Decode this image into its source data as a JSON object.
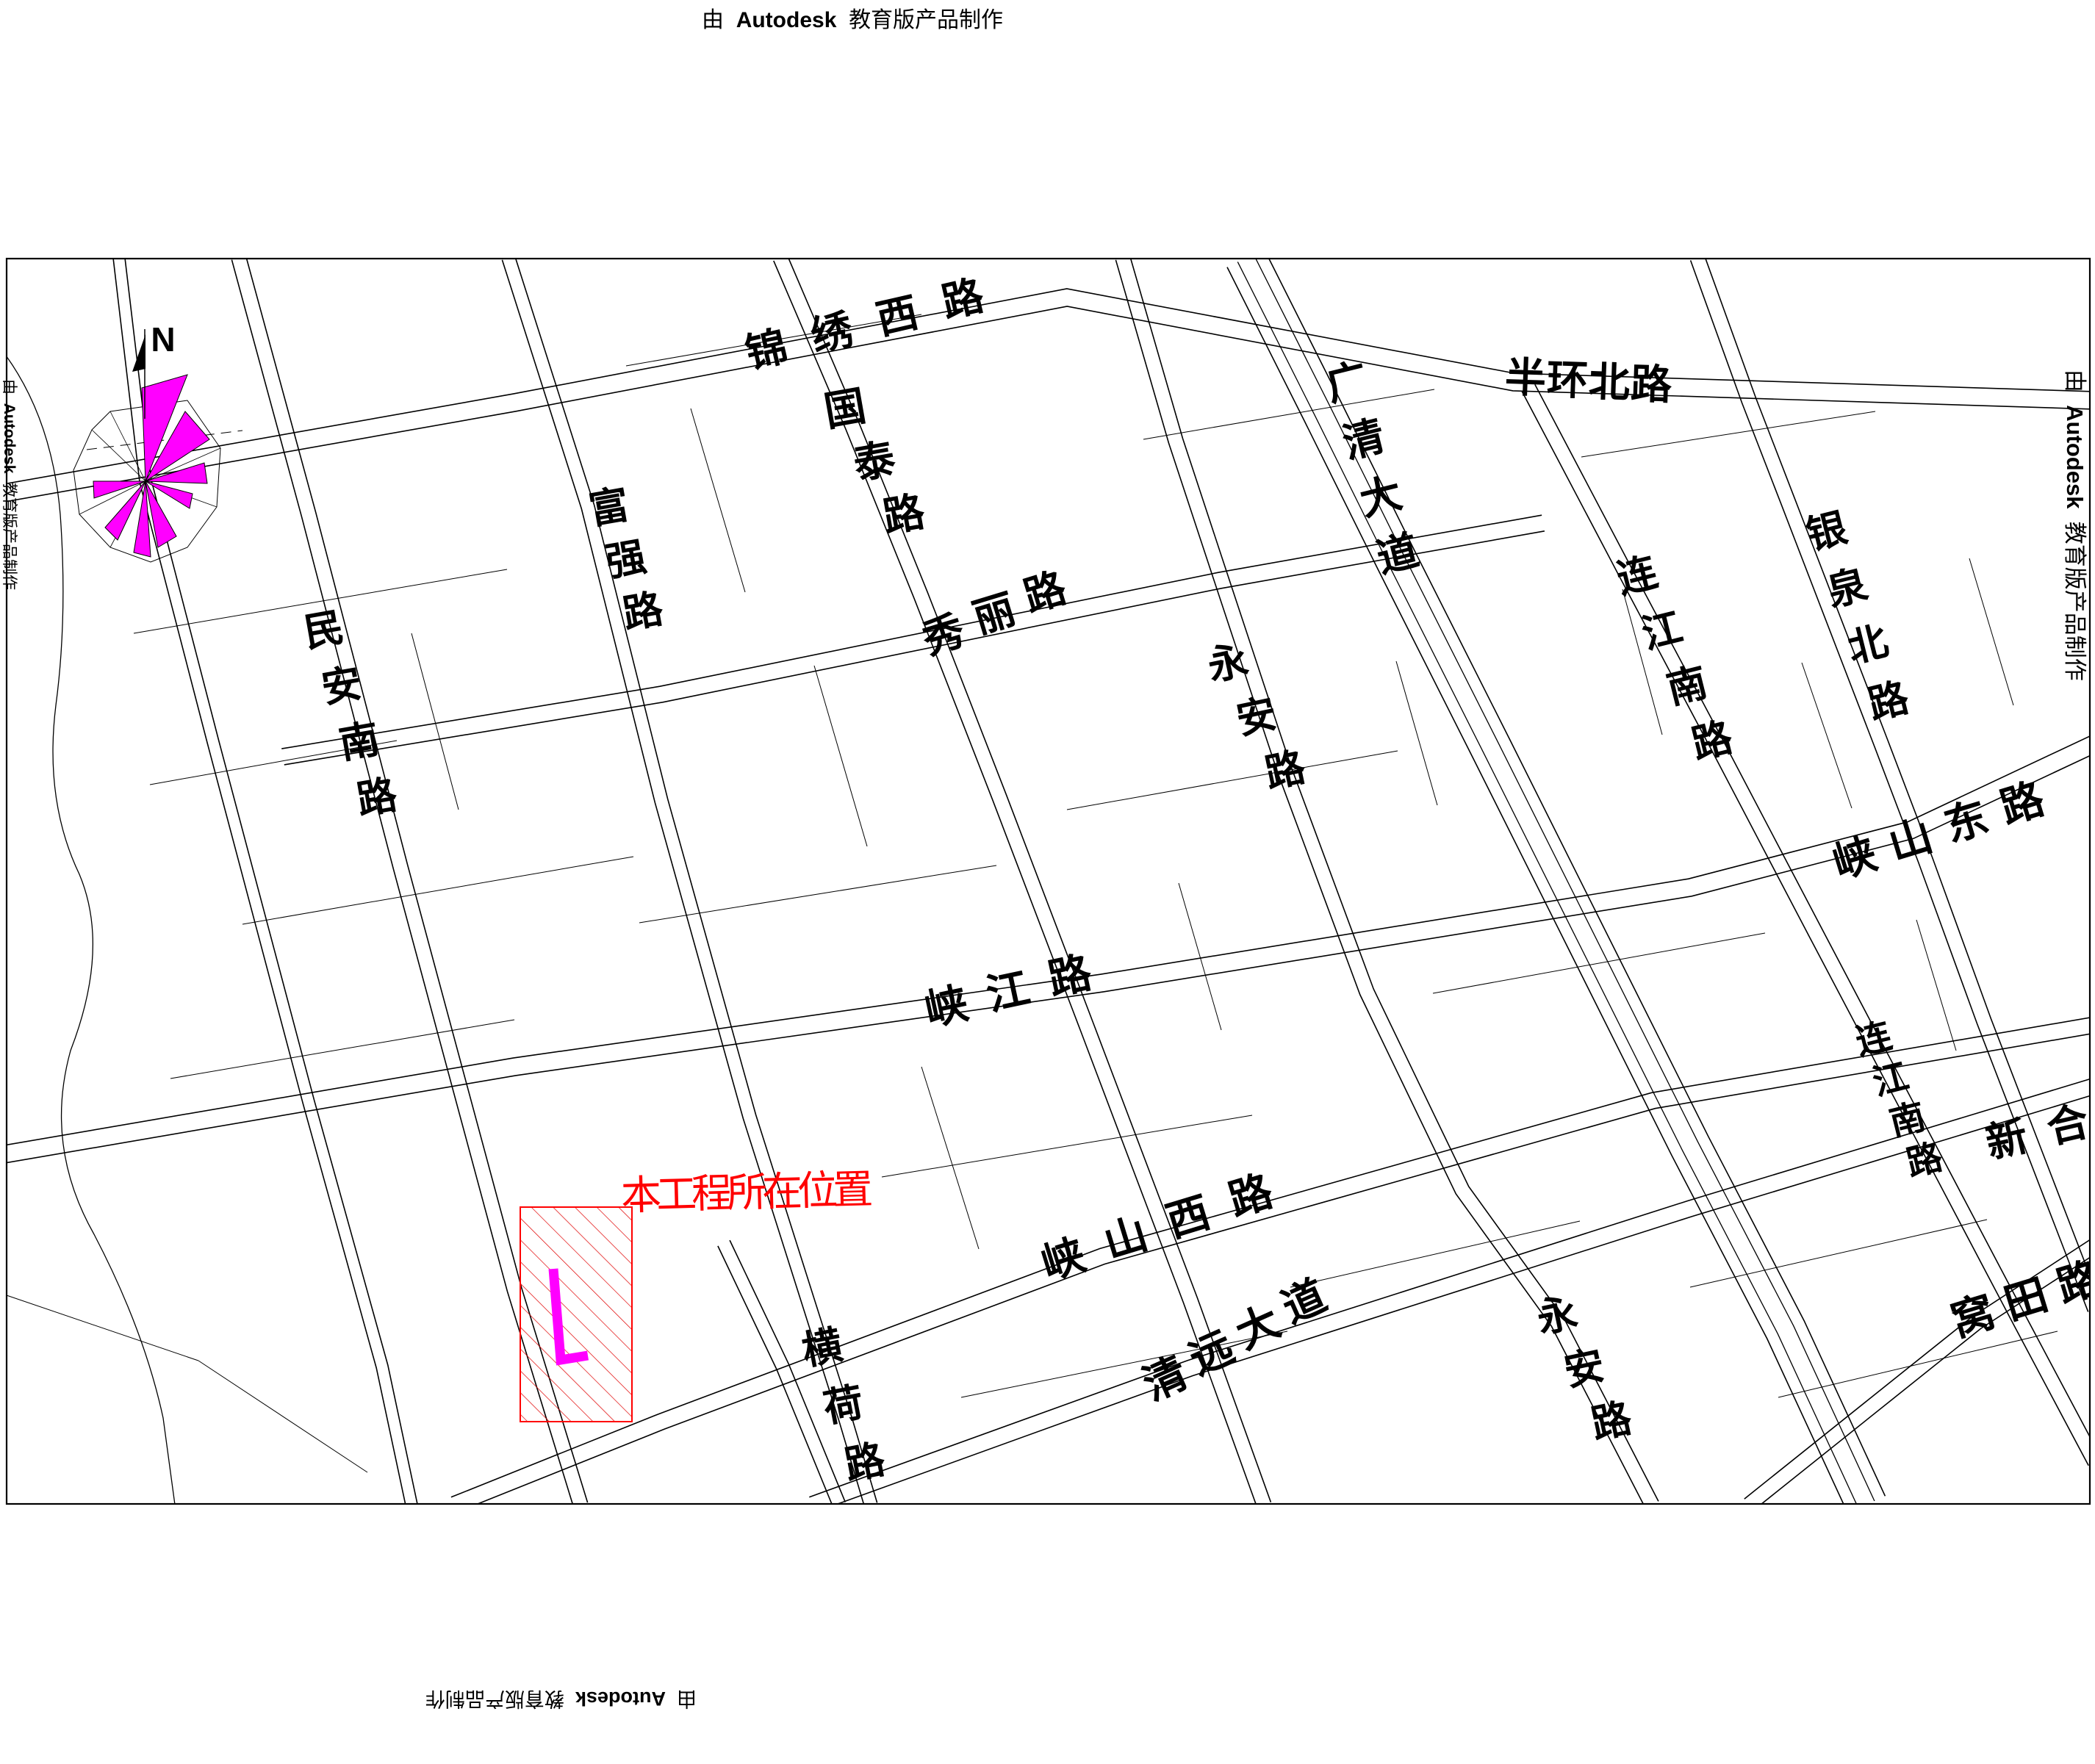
{
  "watermark": {
    "prefix": "由",
    "brand": "Autodesk",
    "suffix": "教育版产品制作"
  },
  "compass": {
    "north_label": "N"
  },
  "legend": {
    "project_location_label": "本工程所在位置"
  },
  "colors": {
    "line_black": "#000000",
    "project_red": "#FF0000",
    "hatch_red": "#E00000",
    "site_magenta": "#FF00FF",
    "wind_rose_magenta": "#FF00FF"
  },
  "roads": [
    {
      "id": "jinxiu",
      "name": "锦绣西路"
    },
    {
      "id": "banhuan",
      "name": "半环北路"
    },
    {
      "id": "guotai",
      "name": "国泰路"
    },
    {
      "id": "guangqing",
      "name": "广清大道"
    },
    {
      "id": "lianjiang-n",
      "name": "连江南路"
    },
    {
      "id": "yinquan",
      "name": "银泉北路"
    },
    {
      "id": "minan",
      "name": "民安南路"
    },
    {
      "id": "fuqiang",
      "name": "富强路"
    },
    {
      "id": "xiuli",
      "name": "秀丽路"
    },
    {
      "id": "yongan-c",
      "name": "永安路"
    },
    {
      "id": "xiajiang",
      "name": "峡江路"
    },
    {
      "id": "xiashan-e",
      "name": "峡山东路"
    },
    {
      "id": "xiashan-w",
      "name": "峡山西路"
    },
    {
      "id": "lianjiang-s",
      "name": "连江南路"
    },
    {
      "id": "xinhe",
      "name": "新合"
    },
    {
      "id": "henghe",
      "name": "横荷路"
    },
    {
      "id": "qingyuan",
      "name": "清远大道"
    },
    {
      "id": "yongan-s",
      "name": "永安路"
    },
    {
      "id": "wotian",
      "name": "窝田路"
    }
  ]
}
